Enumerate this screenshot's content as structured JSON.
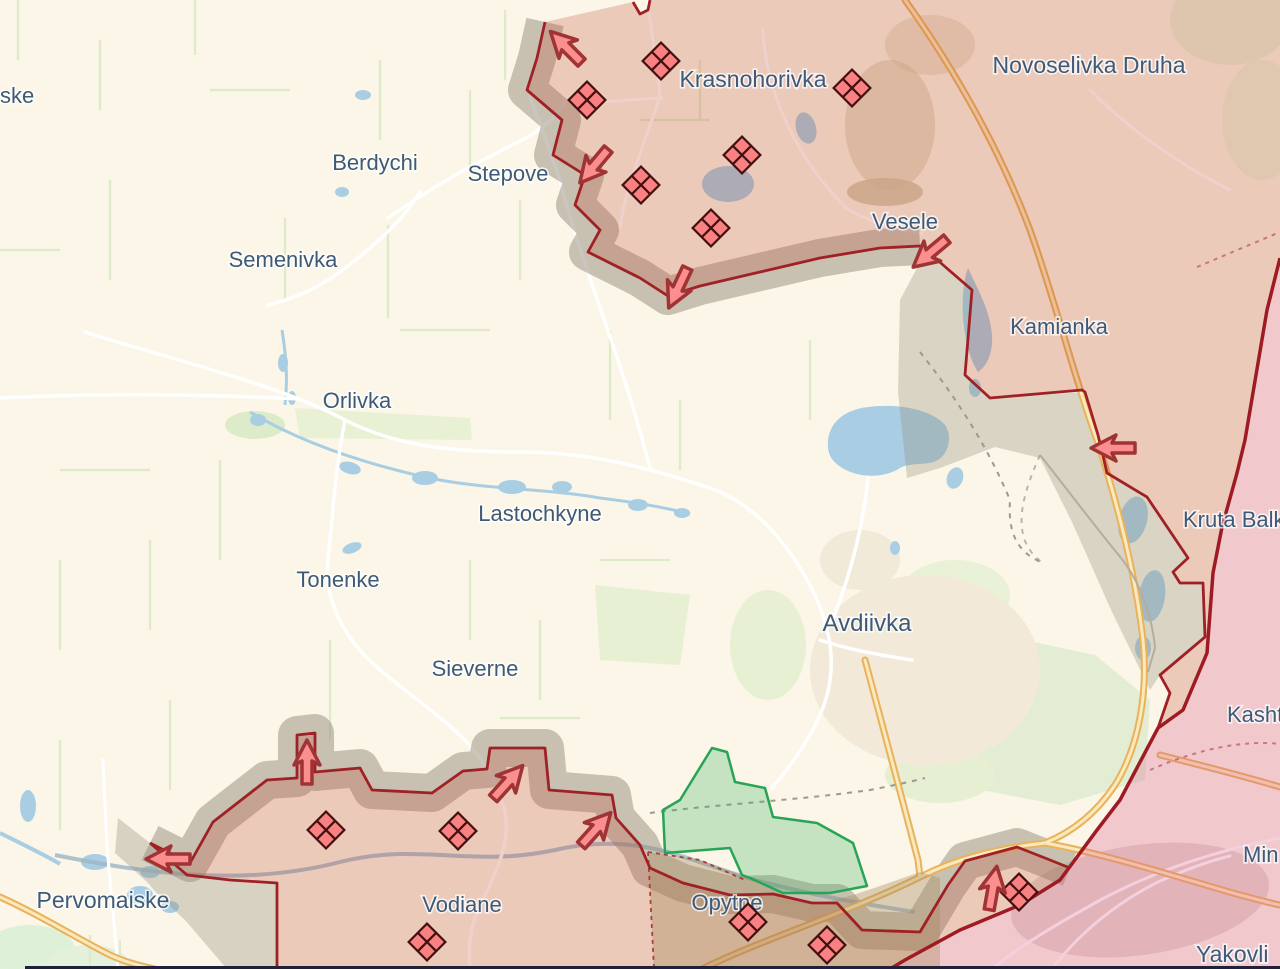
{
  "map": {
    "title": "Avdiivka front-line situation map",
    "labels": [
      {
        "id": "ske",
        "text": "ske",
        "x": 0,
        "y": 103,
        "anchor": "start",
        "fs": 22
      },
      {
        "id": "berdychi",
        "text": "Berdychi",
        "x": 375,
        "y": 170,
        "anchor": "middle",
        "fs": 22
      },
      {
        "id": "stepove",
        "text": "Stepove",
        "x": 508,
        "y": 181,
        "anchor": "middle",
        "fs": 22
      },
      {
        "id": "semenivka",
        "text": "Semenivka",
        "x": 283,
        "y": 267,
        "anchor": "middle",
        "fs": 22
      },
      {
        "id": "krasnohorivka",
        "text": "Krasnohorivka",
        "x": 753,
        "y": 87,
        "anchor": "middle",
        "fs": 23
      },
      {
        "id": "novoselivka-druha",
        "text": "Novoselivka Druha",
        "x": 1089,
        "y": 73,
        "anchor": "middle",
        "fs": 23
      },
      {
        "id": "vesele",
        "text": "Vesele",
        "x": 905,
        "y": 229,
        "anchor": "middle",
        "fs": 22
      },
      {
        "id": "kamianka",
        "text": "Kamianka",
        "x": 1059,
        "y": 334,
        "anchor": "middle",
        "fs": 22
      },
      {
        "id": "orlivka",
        "text": "Orlivka",
        "x": 357,
        "y": 408,
        "anchor": "middle",
        "fs": 22
      },
      {
        "id": "lastochkyne",
        "text": "Lastochkyne",
        "x": 540,
        "y": 521,
        "anchor": "middle",
        "fs": 22
      },
      {
        "id": "tonenke",
        "text": "Tonenke",
        "x": 338,
        "y": 587,
        "anchor": "middle",
        "fs": 22
      },
      {
        "id": "avdiivka",
        "text": "Avdiivka",
        "x": 867,
        "y": 631,
        "anchor": "middle",
        "fs": 24
      },
      {
        "id": "sieverne",
        "text": "Sieverne",
        "x": 475,
        "y": 676,
        "anchor": "middle",
        "fs": 22
      },
      {
        "id": "kruta-balka",
        "text": "Kruta Balk",
        "x": 1183,
        "y": 527,
        "anchor": "start",
        "fs": 22
      },
      {
        "id": "kashtanove",
        "text": "Kasht",
        "x": 1227,
        "y": 722,
        "anchor": "start",
        "fs": 22
      },
      {
        "id": "mineralne",
        "text": "Min",
        "x": 1243,
        "y": 862,
        "anchor": "start",
        "fs": 22
      },
      {
        "id": "yakovlivka",
        "text": "Yakovli",
        "x": 1196,
        "y": 962,
        "anchor": "start",
        "fs": 23
      },
      {
        "id": "pervomaiske",
        "text": "Pervomaiske",
        "x": 103,
        "y": 908,
        "anchor": "middle",
        "fs": 23
      },
      {
        "id": "vodiane",
        "text": "Vodiane",
        "x": 462,
        "y": 912,
        "anchor": "middle",
        "fs": 22
      },
      {
        "id": "opytne",
        "text": "Opytne",
        "x": 727,
        "y": 910,
        "anchor": "middle",
        "fs": 22
      }
    ],
    "unit_markers": [
      {
        "x": 661,
        "y": 61
      },
      {
        "x": 587,
        "y": 100
      },
      {
        "x": 852,
        "y": 88
      },
      {
        "x": 742,
        "y": 155
      },
      {
        "x": 641,
        "y": 185
      },
      {
        "x": 711,
        "y": 228
      },
      {
        "x": 326,
        "y": 830
      },
      {
        "x": 458,
        "y": 831
      },
      {
        "x": 427,
        "y": 942
      },
      {
        "x": 748,
        "y": 922
      },
      {
        "x": 827,
        "y": 945
      },
      {
        "x": 1019,
        "y": 892
      }
    ],
    "attack_arrows": [
      {
        "x": 566,
        "y": 47,
        "rot": 315
      },
      {
        "x": 594,
        "y": 166,
        "rot": 220
      },
      {
        "x": 678,
        "y": 288,
        "rot": 205
      },
      {
        "x": 930,
        "y": 253,
        "rot": 230
      },
      {
        "x": 1113,
        "y": 448,
        "rot": 270
      },
      {
        "x": 307,
        "y": 762,
        "rot": 0
      },
      {
        "x": 508,
        "y": 782,
        "rot": 42
      },
      {
        "x": 596,
        "y": 829,
        "rot": 42
      },
      {
        "x": 168,
        "y": 859,
        "rot": 270
      },
      {
        "x": 993,
        "y": 888,
        "rot": 10
      }
    ],
    "legend_semantics": {
      "salmon_zone": "occupied after 24.02.2022",
      "pink_zone": "occupied before 24.02.2022",
      "grey_zone": "contested / unknown control buffer",
      "green_zone": "liberated / UA advance",
      "diamond_marker": "russian military unit",
      "arrow": "attack direction"
    }
  },
  "colors": {
    "background": "#fbf6e7",
    "label": "#3e5a78",
    "front_line": "#a02125",
    "pre2022_line": "#9e1b24",
    "occupied_fill": "rgba(187,62,40,0.24)",
    "pre2022_fill": "rgba(219,96,141,0.30)",
    "buffer_fill": "rgba(150,140,125,0.34)",
    "green_fill": "rgba(62,178,98,0.28)",
    "green_line": "#27a455",
    "tan_fill": "rgba(166,140,95,0.38)",
    "marker_fill": "#f98181",
    "marker_stroke": "#431010",
    "arrow_fill": "#fb8f8f",
    "arrow_stroke": "#a03333",
    "water": "#a9cee3",
    "road_white": "#ffffff",
    "highway_casing": "#e9b25c",
    "highway_center": "#f9e9bd",
    "field_line": "#dcecc6",
    "bottom_bar": "#20203a"
  }
}
